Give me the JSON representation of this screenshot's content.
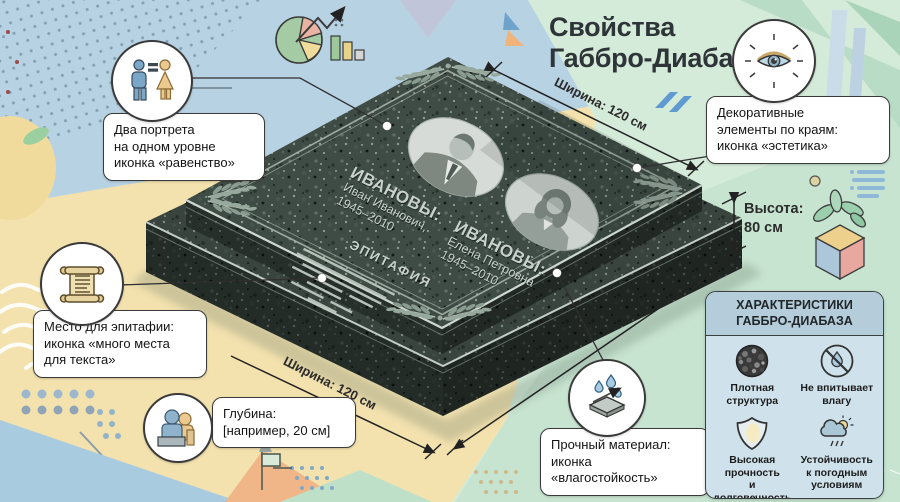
{
  "title": "Свойства\nГаббро-Диабаз",
  "monument": {
    "left_person": {
      "surname": "ИВАНОВЫ:",
      "name": "Иван Иванович,",
      "years": "1945–2010"
    },
    "right_person": {
      "surname": "ИВАНОВЫ:",
      "name": "Елена Петровна",
      "years": "1945–2010"
    },
    "epitaph_label": "ЭПИТАФИЯ"
  },
  "measurements": {
    "width_top": "Ширина: 120 см",
    "width_bottom": "Ширина: 120 см",
    "height": "Высота:\n80 см"
  },
  "callouts": {
    "equality": {
      "icon": "man-woman-equals-icon",
      "text": "Два портрета\nна одном уровне\nиконка «равенство»"
    },
    "epitaph": {
      "icon": "scroll-icon",
      "text": "Место для эпитафии:\nиконка «много места\nдля текста»"
    },
    "depth": {
      "icon": "depth-figures-icon",
      "text": "Глубина:\n[например, 20 см]"
    },
    "decor": {
      "icon": "eye-icon",
      "text": "Декоративные\nэлементы по краям:\nиконка «эстетика»"
    },
    "material": {
      "icon": "water-drops-icon",
      "text": "Прочный материал:\nиконка\n«влагостойкость»"
    }
  },
  "panel": {
    "title": "ХАРАКТЕРИСТИКИ\nГАББРО-ДИАБАЗА",
    "items": [
      {
        "icon": "dense-structure-icon",
        "label": "Плотная\nструктура"
      },
      {
        "icon": "no-water-icon",
        "label": "Не впитывает\nвлагу"
      },
      {
        "icon": "shield-icon",
        "label": "Высокая\nпрочность\nи долговечность"
      },
      {
        "icon": "weather-icon",
        "label": "Устойчивость\nк погодным\nусловиям"
      }
    ]
  },
  "colors": {
    "bg_blue": "#b7d2e3",
    "bg_green": "#d5ebd9",
    "bg_yellow": "#f3e2ae",
    "stone": "#3f4c45",
    "engraving": "#c8d2ca",
    "callout_border": "#3a3a3a",
    "panel_header": "#b5cdda",
    "panel_body": "#cfe2eb",
    "accent_blue": "#5f9bd0"
  }
}
